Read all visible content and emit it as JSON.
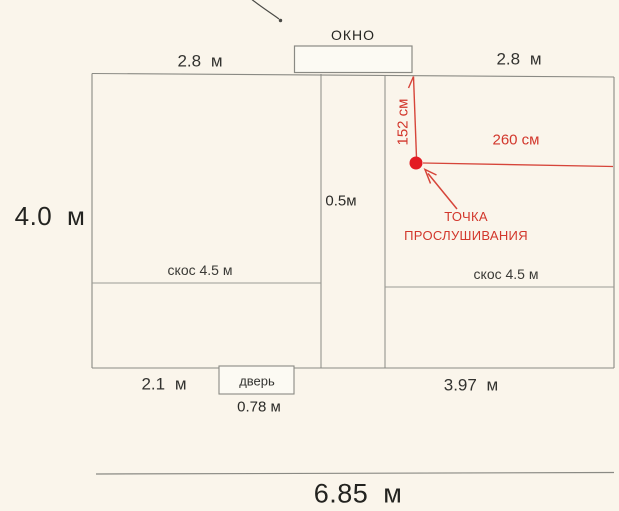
{
  "plan": {
    "window_label": "ОКНО",
    "top_width_left": "2.8 м",
    "top_width_right": "2.8 м",
    "left_height": "4.0 м",
    "partition_width": "0.5м",
    "skos_left_label": "скос 4.5 м",
    "skos_right_label": "скос 4.5 м",
    "bottom_width_left": "2.1 м",
    "door_label": "дверь",
    "door_width": "0.78 м",
    "bottom_width_right": "3.97 м",
    "total_width": "6.85 м",
    "measure_vertical": "152 см",
    "measure_horizontal": "260 см",
    "listening_point_label": "ТОЧКА\nПРОСЛУШИВАНИЯ"
  },
  "colors": {
    "background": "#faf5eb",
    "wall_line": "#8a8a84",
    "skos_line": "#9b9b94",
    "text": "#2b2b28",
    "red_accent": "#d2372c",
    "red_line": "#d6453a",
    "red_dot": "#e31b23"
  }
}
